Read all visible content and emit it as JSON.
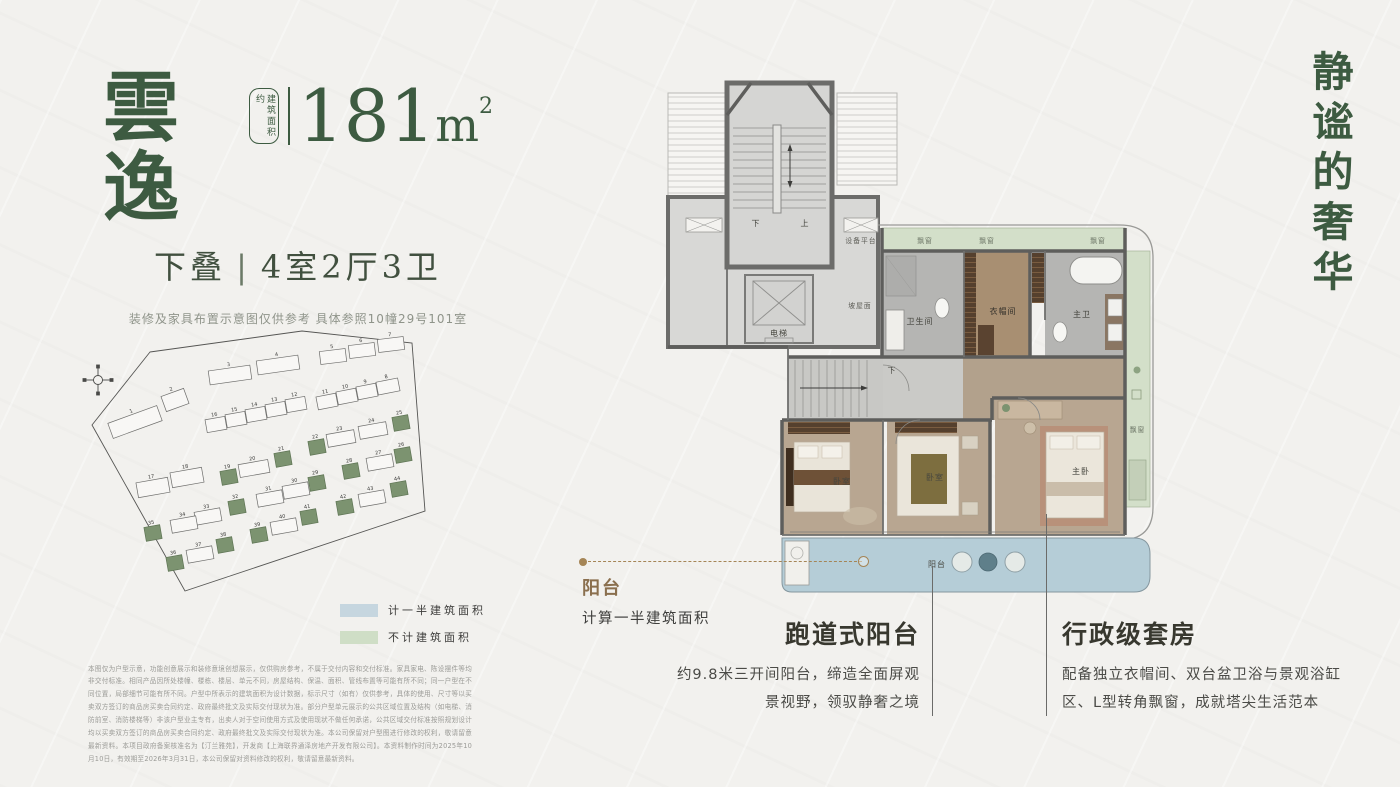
{
  "colors": {
    "accent_green": "#3d5b41",
    "callout_brown": "#8a6f4e",
    "balcony_blue": "#b5cdd7",
    "bay_green": "#d3dfc9",
    "legend_half": "#c6d6df",
    "legend_none": "#cfdec6",
    "highlight_building": "#7c9370"
  },
  "header": {
    "name": "雲逸",
    "area_label": "建筑面积约",
    "area_value": "181",
    "area_unit_base": "m",
    "area_unit_sup": "2",
    "subtitle_type": "下叠",
    "subtitle_sep": "|",
    "subtitle_rooms": "4室2厅3卫",
    "note": "装修及家具布置示意图仅供参考 具体参照10幢29号101室"
  },
  "slogan": "静谧的奢华",
  "siteplan": {
    "boundary": "75,24 227,3 337,15 350,183 110,263 17,97",
    "buildings": [
      {
        "n": 1,
        "x": 34,
        "y": 86,
        "w": 52,
        "h": 16,
        "r": -20
      },
      {
        "n": 2,
        "x": 88,
        "y": 64,
        "w": 24,
        "h": 16,
        "r": -20
      },
      {
        "n": 3,
        "x": 134,
        "y": 40,
        "w": 42,
        "h": 14,
        "r": -8
      },
      {
        "n": 4,
        "x": 182,
        "y": 30,
        "w": 42,
        "h": 14,
        "r": -8
      },
      {
        "n": 5,
        "x": 245,
        "y": 22,
        "w": 26,
        "h": 13,
        "r": -7
      },
      {
        "n": 6,
        "x": 274,
        "y": 16,
        "w": 26,
        "h": 13,
        "r": -7
      },
      {
        "n": 7,
        "x": 303,
        "y": 10,
        "w": 26,
        "h": 13,
        "r": -7
      },
      {
        "n": 8,
        "x": 302,
        "y": 52,
        "w": 22,
        "h": 13,
        "r": -11
      },
      {
        "n": 9,
        "x": 282,
        "y": 57,
        "w": 20,
        "h": 13,
        "r": -11
      },
      {
        "n": 10,
        "x": 262,
        "y": 62,
        "w": 20,
        "h": 13,
        "r": -11
      },
      {
        "n": 11,
        "x": 242,
        "y": 67,
        "w": 20,
        "h": 13,
        "r": -11
      },
      {
        "n": 12,
        "x": 211,
        "y": 70,
        "w": 20,
        "h": 13,
        "r": -10
      },
      {
        "n": 13,
        "x": 191,
        "y": 75,
        "w": 20,
        "h": 13,
        "r": -10
      },
      {
        "n": 14,
        "x": 171,
        "y": 80,
        "w": 20,
        "h": 13,
        "r": -10
      },
      {
        "n": 15,
        "x": 151,
        "y": 85,
        "w": 20,
        "h": 13,
        "r": -10
      },
      {
        "n": 16,
        "x": 131,
        "y": 90,
        "w": 20,
        "h": 13,
        "r": -10
      },
      {
        "n": 17,
        "x": 62,
        "y": 152,
        "w": 32,
        "h": 15,
        "r": -10
      },
      {
        "n": 18,
        "x": 96,
        "y": 142,
        "w": 32,
        "h": 15,
        "r": -10
      },
      {
        "n": 19,
        "x": 146,
        "y": 142,
        "w": 16,
        "h": 14,
        "r": -10,
        "g": true
      },
      {
        "n": 20,
        "x": 164,
        "y": 134,
        "w": 30,
        "h": 13,
        "r": -10
      },
      {
        "n": 21,
        "x": 200,
        "y": 124,
        "w": 16,
        "h": 14,
        "r": -10,
        "g": true
      },
      {
        "n": 22,
        "x": 234,
        "y": 112,
        "w": 16,
        "h": 14,
        "r": -10,
        "g": true
      },
      {
        "n": 23,
        "x": 252,
        "y": 104,
        "w": 28,
        "h": 13,
        "r": -10
      },
      {
        "n": 24,
        "x": 284,
        "y": 96,
        "w": 28,
        "h": 13,
        "r": -10
      },
      {
        "n": 25,
        "x": 318,
        "y": 88,
        "w": 16,
        "h": 14,
        "r": -10,
        "g": true
      },
      {
        "n": 26,
        "x": 320,
        "y": 120,
        "w": 16,
        "h": 14,
        "r": -10,
        "g": true
      },
      {
        "n": 27,
        "x": 292,
        "y": 128,
        "w": 26,
        "h": 13,
        "r": -10
      },
      {
        "n": 28,
        "x": 268,
        "y": 136,
        "w": 16,
        "h": 14,
        "r": -10,
        "g": true
      },
      {
        "n": 29,
        "x": 234,
        "y": 148,
        "w": 16,
        "h": 14,
        "r": -10,
        "g": true
      },
      {
        "n": 30,
        "x": 208,
        "y": 156,
        "w": 26,
        "h": 13,
        "r": -10
      },
      {
        "n": 31,
        "x": 182,
        "y": 164,
        "w": 26,
        "h": 13,
        "r": -10
      },
      {
        "n": 32,
        "x": 154,
        "y": 172,
        "w": 16,
        "h": 14,
        "r": -10,
        "g": true
      },
      {
        "n": 33,
        "x": 120,
        "y": 182,
        "w": 26,
        "h": 13,
        "r": -10
      },
      {
        "n": 34,
        "x": 96,
        "y": 190,
        "w": 26,
        "h": 13,
        "r": -10
      },
      {
        "n": 35,
        "x": 70,
        "y": 198,
        "w": 16,
        "h": 14,
        "r": -10,
        "g": true
      },
      {
        "n": 36,
        "x": 92,
        "y": 228,
        "w": 16,
        "h": 14,
        "r": -10,
        "g": true
      },
      {
        "n": 37,
        "x": 112,
        "y": 220,
        "w": 26,
        "h": 13,
        "r": -10
      },
      {
        "n": 38,
        "x": 142,
        "y": 210,
        "w": 16,
        "h": 14,
        "r": -10,
        "g": true
      },
      {
        "n": 39,
        "x": 176,
        "y": 200,
        "w": 16,
        "h": 14,
        "r": -10,
        "g": true
      },
      {
        "n": 40,
        "x": 196,
        "y": 192,
        "w": 26,
        "h": 13,
        "r": -10
      },
      {
        "n": 41,
        "x": 226,
        "y": 182,
        "w": 16,
        "h": 14,
        "r": -10,
        "g": true
      },
      {
        "n": 42,
        "x": 262,
        "y": 172,
        "w": 16,
        "h": 14,
        "r": -10,
        "g": true
      },
      {
        "n": 43,
        "x": 284,
        "y": 164,
        "w": 26,
        "h": 13,
        "r": -10
      },
      {
        "n": 44,
        "x": 316,
        "y": 154,
        "w": 16,
        "h": 14,
        "r": -10,
        "g": true
      }
    ]
  },
  "legend": {
    "items": [
      {
        "label": "计一半建筑面积",
        "color": "#c6d6df"
      },
      {
        "label": "不计建筑面积",
        "color": "#cfdec6"
      }
    ]
  },
  "floorplan": {
    "labels": {
      "up": "上",
      "down": "下",
      "equipment_platform": "设备平台",
      "elevator": "电梯",
      "sloped_roof": "坡屋面",
      "bay_window": "飘窗",
      "bathroom": "卫生间",
      "cloakroom": "衣帽间",
      "master_bath": "主卫",
      "bedroom": "卧室",
      "master_bedroom": "主卧",
      "balcony": "阳台"
    }
  },
  "balcony_callout": {
    "title": "阳台",
    "desc": "计算一半建筑面积"
  },
  "annotations": [
    {
      "title": "跑道式阳台",
      "line1": "约9.8米三开间阳台，缔造全面屏观",
      "line2": "景视野，领驭静奢之境"
    },
    {
      "title": "行政级套房",
      "line1": "配备独立衣帽间、双台盆卫浴与景观浴缸",
      "line2": "区、L型转角飘窗，成就塔尖生活范本"
    }
  ],
  "disclaimer": "本图仅为户型示意，功能创意展示和装修意境创想展示，仅供购房参考，不属于交付内容和交付标准。家具家电、陈设摆件等均非交付标准。相同产品因所处楼幢、楼栋、楼层、单元不同，房屋结构、保温、面积、管线布置等可能有所不同；同一户型在不同位置，局部细节可能有所不同。户型中所表示的建筑面积为设计数据，标示尺寸（如有）仅供参考，具体的使用、尺寸等以买卖双方签订的商品房买卖合同约定、政府最终批文及实际交付现状为准。部分户型单元展示的公共区域位置及结构（如电梯、消防前室、消防楼梯等）非该户型业主专有，出卖人对于空间使用方式及使用现状不做任何承诺，公共区域交付标准按照规划设计均以买卖双方签订的商品房买卖合同约定、政府最终批文及实际交付现状为准。本公司保留对户型图进行修改的权利，敬请留意最新资料。本项目政府备案核准名为【汀兰雅苑】，开发商【上海联界通泽房地产开发有限公司】。本资料制作时间为2025年10月10日，有效期至2026年3月31日，本公司保留对资料修改的权利，敬请留意最新资料。"
}
